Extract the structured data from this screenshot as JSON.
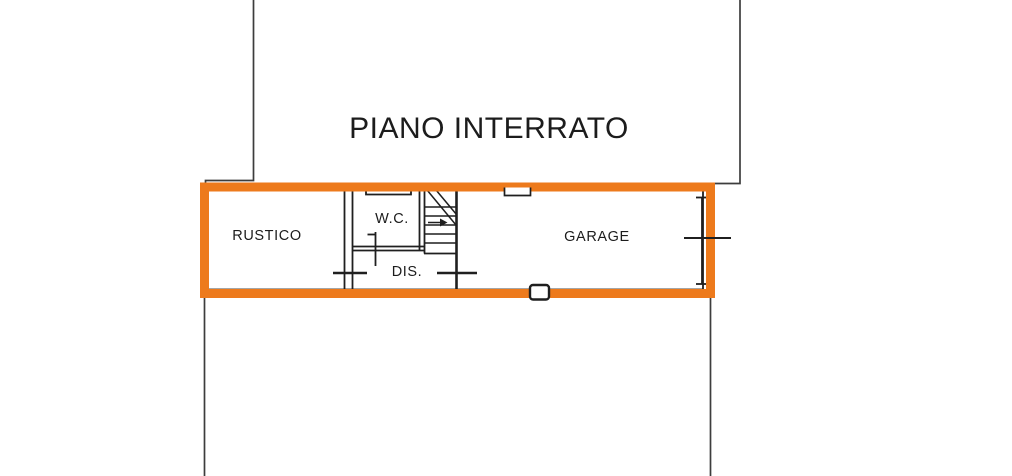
{
  "title": "PIANO INTERRATO",
  "rooms": {
    "rustico": {
      "label": "RUSTICO"
    },
    "wc": {
      "label": "W.C."
    },
    "dis": {
      "label": "DIS."
    },
    "garage": {
      "label": "GARAGE"
    }
  },
  "colors": {
    "highlight": "#ED7A1C",
    "outline": "#3d3d3d",
    "wall": "#1f1f1f",
    "text": "#1c1c1c",
    "background": "#ffffff"
  }
}
